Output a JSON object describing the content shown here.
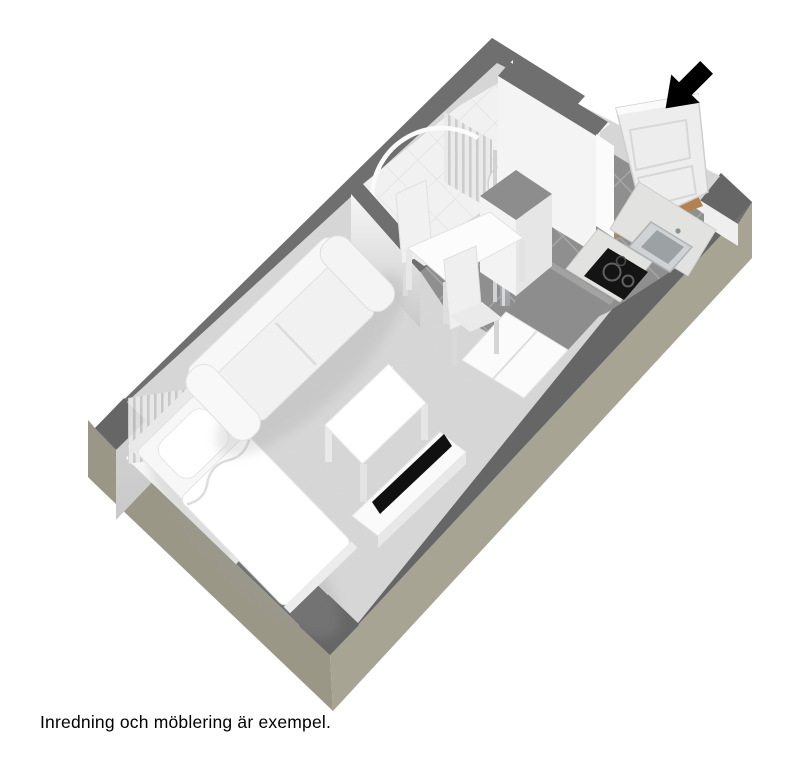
{
  "scene": {
    "type": "3d-floorplan",
    "subject": "studio apartment with bathroom, hall, kitchenette and living/sleeping area",
    "entrance_marker": "black arrow pointing at front door"
  },
  "caption": "Inredning och möblering är exempel.",
  "colors": {
    "background": "#ffffff",
    "wallTop": "#6f6f6f",
    "wallTopNear": "#666666",
    "extLeft": "#9b9786",
    "extRight": "#a8a494",
    "carpet": "#d8d8d8",
    "wallFaceTop": "#f6f6f6",
    "wallFaceBottom": "#c9c9c9",
    "wallFaceFlat": "#efefef",
    "tileFloor": "#8f8f8f",
    "tileGrout": "#a7a7a7",
    "bathTile": "#f1f1f1",
    "bathTileLine": "#e2e2e2",
    "wood": "#b2834f",
    "furnitureWhite": "#f7f7f7",
    "furnitureShade": "#e3e3e3",
    "tv": "#101010",
    "cooktop": "#141414",
    "steelTop": "#d9dcde",
    "steelBottom": "#9fa4a7",
    "sinkBasin": "#9ca1a4",
    "sinkRim": "#cfd3d5",
    "glass": "#7fa0c9",
    "door": "#ededed",
    "marble": "#e2e2e0",
    "grayUnit": "#8d8d8d",
    "arrow": "#000000",
    "captionColor": "#000000"
  }
}
